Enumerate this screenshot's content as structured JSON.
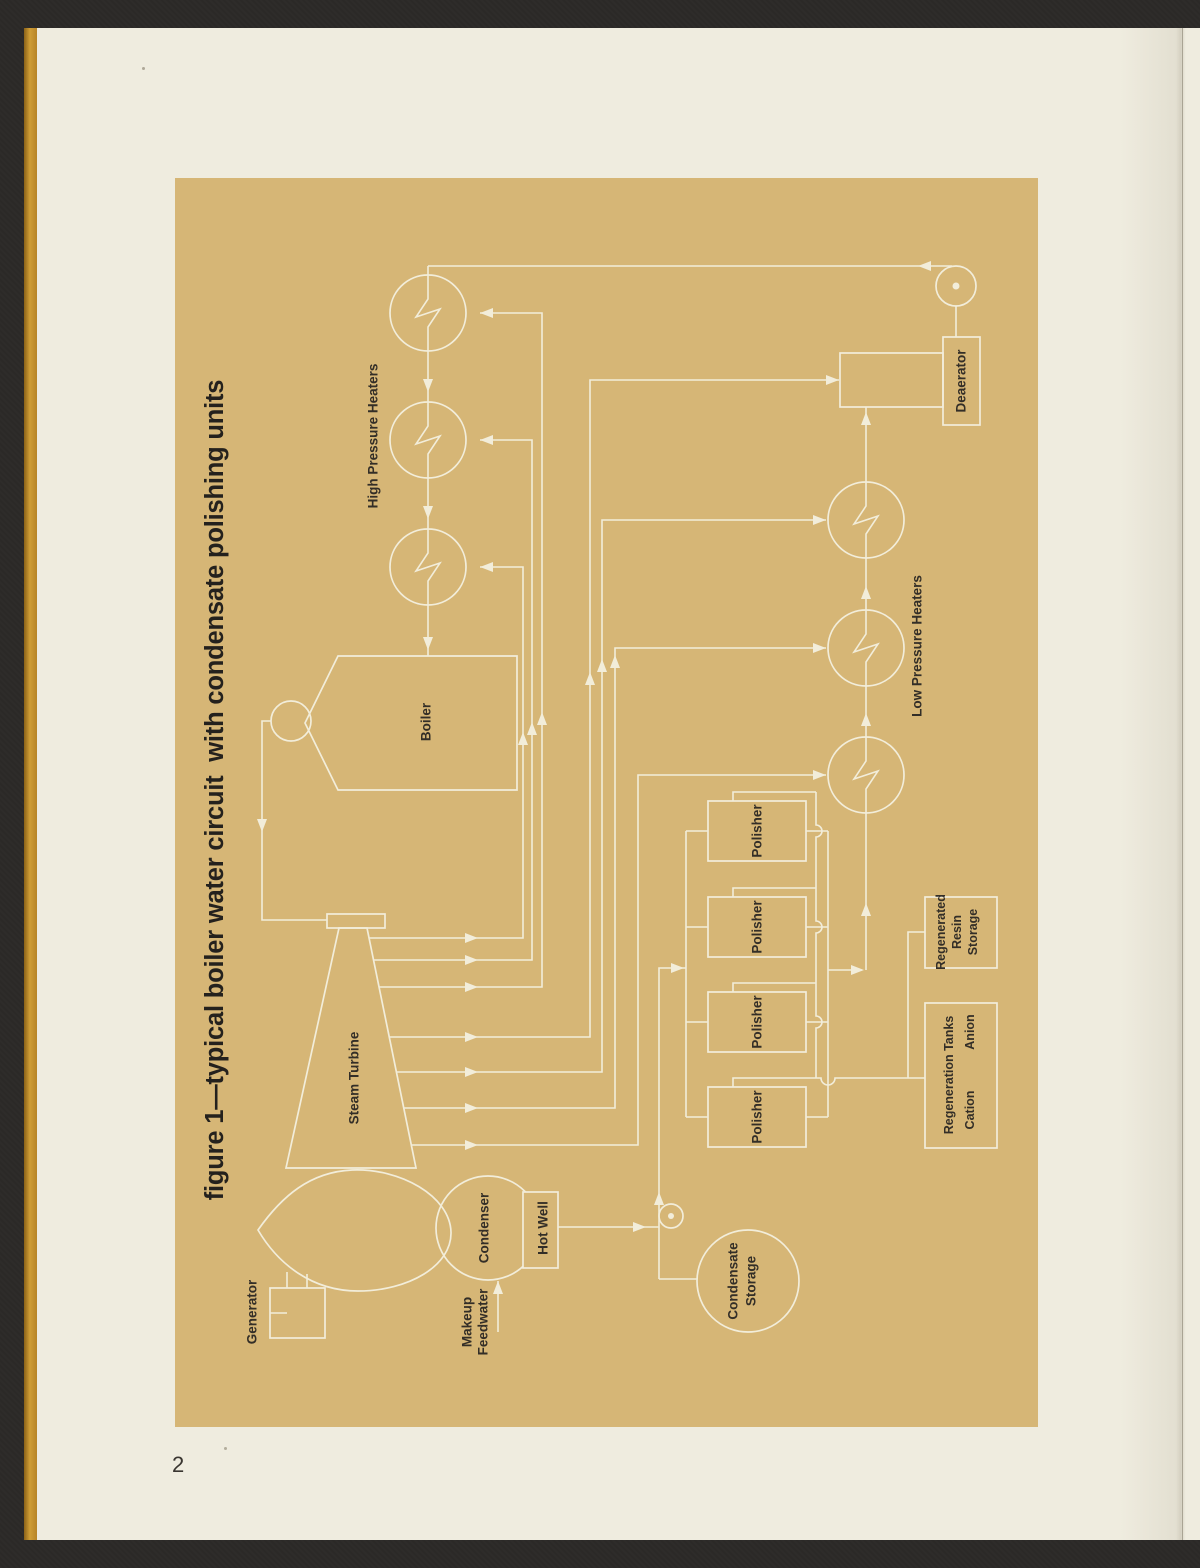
{
  "page": {
    "number": "2"
  },
  "figure": {
    "title": "figure 1—typical boiler water circuit  with condensate polishing units"
  },
  "labels": {
    "hp_heaters": "High Pressure Heaters",
    "lp_heaters": "Low Pressure Heaters",
    "boiler": "Boiler",
    "deaerator": "Deaerator",
    "steam_turbine": "Steam Turbine",
    "generator": "Generator",
    "condenser": "Condenser",
    "hot_well": "Hot Well",
    "makeup_1": "Makeup",
    "makeup_2": "Feedwater",
    "cond_storage_1": "Condensate",
    "cond_storage_2": "Storage",
    "polisher": "Polisher",
    "regen_resin_1": "Regenerated",
    "regen_resin_2": "Resin",
    "regen_resin_3": "Storage",
    "regen_tanks": "Regeneration Tanks",
    "cation": "Cation",
    "anion": "Anion"
  },
  "colors": {
    "scanner_background": "#2b2927",
    "page_paper": "#efecdf",
    "figure_panel": "#d6b676",
    "diagram_lines": "#f2edda",
    "label_ink": "#332e27",
    "spine_edge": "#cf9d35"
  }
}
